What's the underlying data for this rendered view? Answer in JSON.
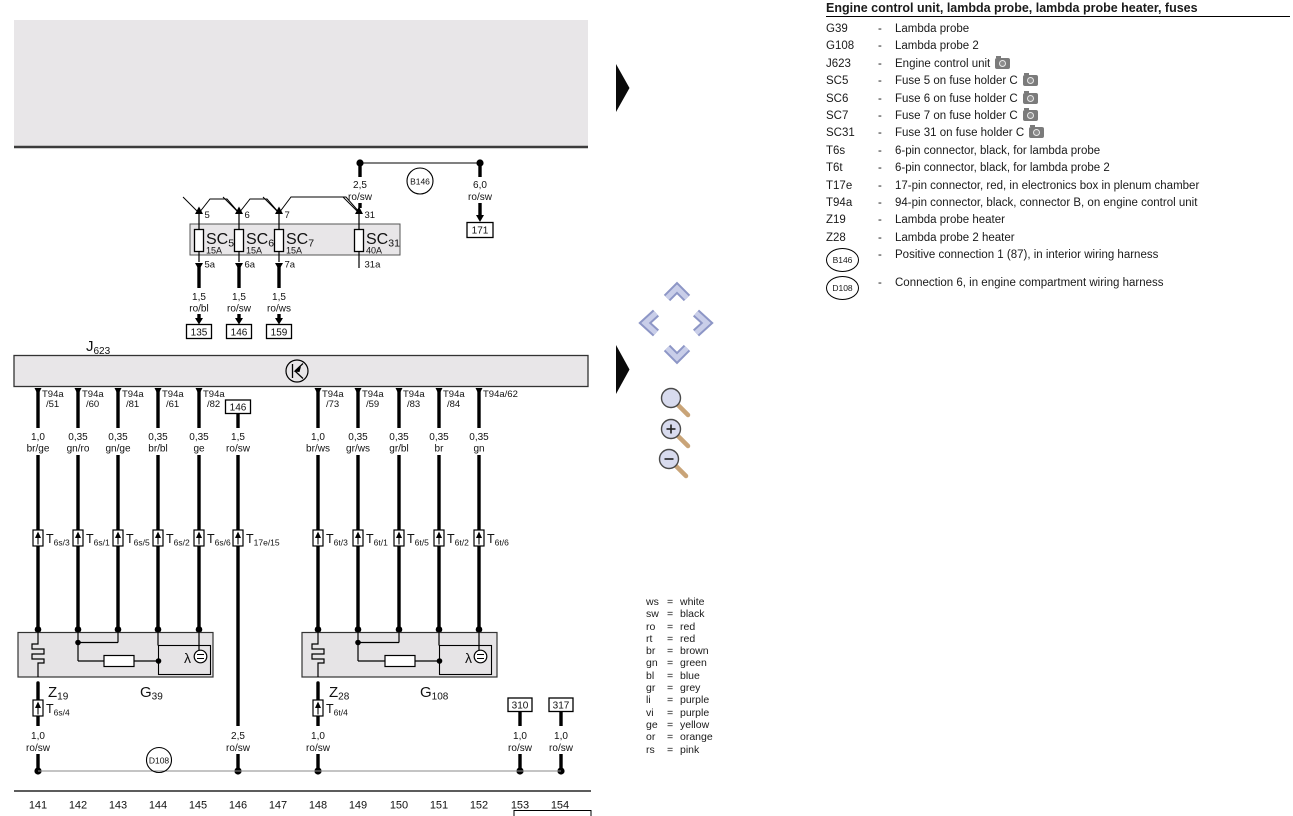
{
  "legend": {
    "title": "Engine control unit, lambda probe, lambda probe heater, fuses",
    "separator": "-",
    "items": [
      {
        "term": "G39",
        "desc": "Lambda probe"
      },
      {
        "term": "G108",
        "desc": "Lambda probe 2"
      },
      {
        "term": "J623",
        "desc": "Engine control unit",
        "camera": true
      },
      {
        "term": "SC5",
        "desc": "Fuse 5 on fuse holder C",
        "camera": true
      },
      {
        "term": "SC6",
        "desc": "Fuse 6 on fuse holder C",
        "camera": true
      },
      {
        "term": "SC7",
        "desc": "Fuse 7 on fuse holder C",
        "camera": true
      },
      {
        "term": "SC31",
        "desc": "Fuse 31 on fuse holder C",
        "camera": true
      },
      {
        "term": "T6s",
        "desc": "6-pin connector, black, for lambda probe"
      },
      {
        "term": "T6t",
        "desc": "6-pin connector, black, for lambda probe 2"
      },
      {
        "term": "T17e",
        "desc": "17-pin connector, red, in electronics box in plenum chamber"
      },
      {
        "term": "T94a",
        "desc": "94-pin connector, black, connector B, on engine control unit"
      },
      {
        "term": "Z19",
        "desc": "Lambda probe heater"
      },
      {
        "term": "Z28",
        "desc": "Lambda probe 2 heater"
      },
      {
        "term": "B146",
        "desc": "Positive connection 1 (87), in interior wiring harness",
        "circled": true
      },
      {
        "term": "D108",
        "desc": "Connection 6, in engine compartment wiring harness",
        "circled": true
      }
    ]
  },
  "color_code": {
    "equals": "=",
    "entries": [
      {
        "code": "ws",
        "name": "white"
      },
      {
        "code": "sw",
        "name": "black"
      },
      {
        "code": "ro",
        "name": "red"
      },
      {
        "code": "rt",
        "name": "red"
      },
      {
        "code": "br",
        "name": "brown"
      },
      {
        "code": "gn",
        "name": "green"
      },
      {
        "code": "bl",
        "name": "blue"
      },
      {
        "code": "gr",
        "name": "grey"
      },
      {
        "code": "li",
        "name": "purple"
      },
      {
        "code": "vi",
        "name": "purple"
      },
      {
        "code": "ge",
        "name": "yellow"
      },
      {
        "code": "or",
        "name": "orange"
      },
      {
        "code": "rs",
        "name": "pink"
      }
    ]
  },
  "diagram": {
    "top": {
      "gauge_l": "2,5",
      "color_l": "ro/sw",
      "node": "B146",
      "gauge_r": "6,0",
      "color_r": "ro/sw",
      "dest": "171"
    },
    "fuse_strip": {
      "fuses": [
        {
          "name": "SC",
          "sub": "5",
          "amps": "15A",
          "pin_top": "5",
          "pin_bot": "5a"
        },
        {
          "name": "SC",
          "sub": "6",
          "amps": "15A",
          "pin_top": "6",
          "pin_bot": "6a"
        },
        {
          "name": "SC",
          "sub": "7",
          "amps": "15A",
          "pin_top": "7",
          "pin_bot": "7a"
        },
        {
          "name": "SC",
          "sub": "31",
          "amps": "40A",
          "pin_top": "31",
          "pin_bot": "31a"
        }
      ]
    },
    "fuse_wires": [
      {
        "gauge": "1,5",
        "color": "ro/bl",
        "dest": "135"
      },
      {
        "gauge": "1,5",
        "color": "ro/sw",
        "dest": "146"
      },
      {
        "gauge": "1,5",
        "color": "ro/ws",
        "dest": "159"
      }
    ],
    "ecu": {
      "name": "J",
      "sub": "623"
    },
    "wires": [
      {
        "pin1": "T94a",
        "pin2": "/51",
        "gauge": "1,0",
        "color": "br/ge",
        "conn": "T",
        "conn_sub": "6s/3"
      },
      {
        "pin1": "T94a",
        "pin2": "/60",
        "gauge": "0,35",
        "color": "gn/ro",
        "conn": "T",
        "conn_sub": "6s/1"
      },
      {
        "pin1": "T94a",
        "pin2": "/81",
        "gauge": "0,35",
        "color": "gn/ge",
        "conn": "T",
        "conn_sub": "6s/5"
      },
      {
        "pin1": "T94a",
        "pin2": "/61",
        "gauge": "0,35",
        "color": "br/bl",
        "conn": "T",
        "conn_sub": "6s/2"
      },
      {
        "pin1": "T94a",
        "pin2": "/82",
        "gauge": "0,35",
        "color": "ge",
        "conn": "T",
        "conn_sub": "6s/6"
      },
      {
        "src": "146",
        "gauge": "1,5",
        "color": "ro/sw",
        "conn": "T",
        "conn_sub": "17e/15"
      },
      {
        "pin1": "T94a",
        "pin2": "/73",
        "gauge": "1,0",
        "color": "br/ws",
        "conn": "T",
        "conn_sub": "6t/3"
      },
      {
        "pin1": "T94a",
        "pin2": "/59",
        "gauge": "0,35",
        "color": "gr/ws",
        "conn": "T",
        "conn_sub": "6t/1"
      },
      {
        "pin1": "T94a",
        "pin2": "/83",
        "gauge": "0,35",
        "color": "gr/bl",
        "conn": "T",
        "conn_sub": "6t/5"
      },
      {
        "pin1": "T94a",
        "pin2": "/84",
        "gauge": "0,35",
        "color": "br",
        "conn": "T",
        "conn_sub": "6t/2"
      },
      {
        "pin1": "T94a/62",
        "pin2": "",
        "gauge": "0,35",
        "color": "gn",
        "conn": "T",
        "conn_sub": "6t/6"
      }
    ],
    "lambda1": {
      "z": "Z",
      "z_sub": "19",
      "g": "G",
      "g_sub": "39",
      "sym": "λ",
      "conn": "T",
      "conn_sub": "6s/4",
      "gauge": "1,0",
      "color": "ro/sw"
    },
    "lambda2": {
      "z": "Z",
      "z_sub": "28",
      "g": "G",
      "g_sub": "108",
      "sym": "λ",
      "conn": "T",
      "conn_sub": "6t/4",
      "gauge": "1,0",
      "color": "ro/sw"
    },
    "bottom": {
      "node": "D108",
      "mid_gauge": "2,5",
      "mid_color": "ro/sw",
      "tap1": {
        "box": "310",
        "gauge": "1,0",
        "color": "ro/sw"
      },
      "tap2": {
        "box": "317",
        "gauge": "1,0",
        "color": "ro/sw"
      }
    },
    "tracks": [
      "141",
      "142",
      "143",
      "144",
      "145",
      "146",
      "147",
      "148",
      "149",
      "150",
      "151",
      "152",
      "153",
      "154"
    ]
  }
}
